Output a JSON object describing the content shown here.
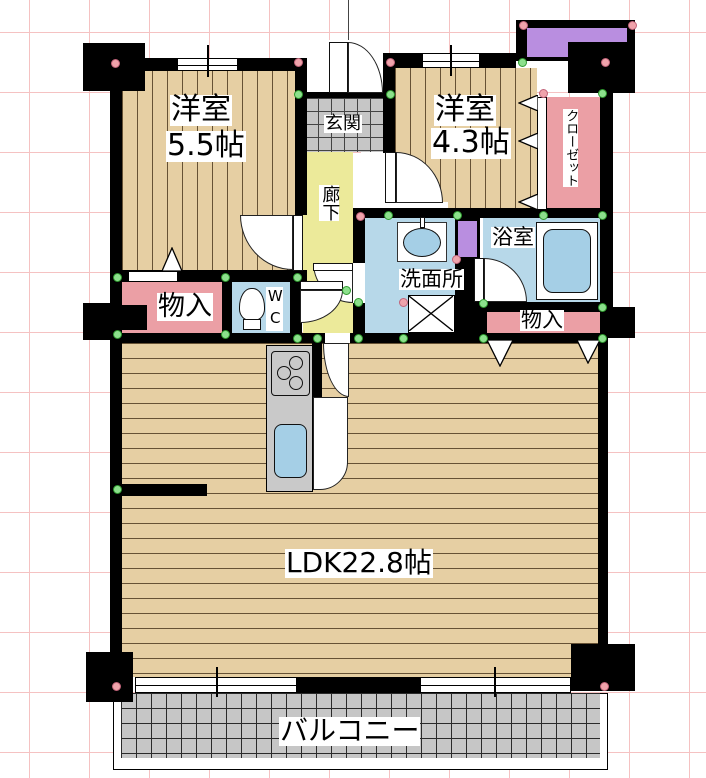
{
  "plan_title": "2LDK floor plan",
  "rooms": {
    "western_room_1": {
      "name": "洋室",
      "size": "5.5帖"
    },
    "western_room_2": {
      "name": "洋室",
      "size": "4.3帖"
    },
    "ldk": {
      "label": "LDK22.8帖"
    },
    "balcony": {
      "label": "バルコニー"
    },
    "entrance": {
      "label": "玄関"
    },
    "hallway": {
      "label": "廊下"
    },
    "closet": {
      "label": "クローゼット"
    },
    "bathroom": {
      "label": "浴室"
    },
    "washroom": {
      "label": "洗面所"
    },
    "toilet": {
      "label": "WC"
    },
    "storage_left": {
      "label": "物入"
    },
    "storage_right": {
      "label": "物入"
    }
  },
  "colors": {
    "wall": "#000000",
    "wood_floor": "#e6cfa3",
    "storage_pink": "#eb9fa5",
    "wet_area_blue": "#b7d8e9",
    "hallway_yellow": "#ecea9a",
    "tile_gray": "#c6c6c6",
    "fixture_purple": "#b98ee0",
    "grid_pink": "#f5c2c2",
    "junction_green_dot": "#8ce08c",
    "corner_pink_dot": "#efa3ab"
  }
}
